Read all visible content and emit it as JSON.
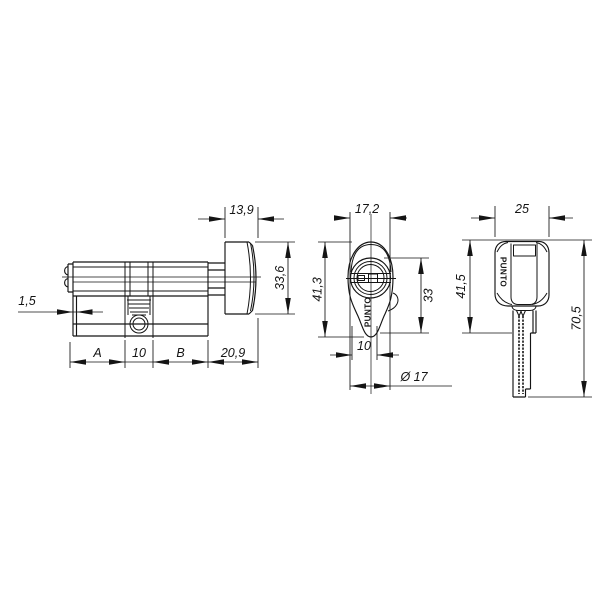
{
  "drawing": {
    "background": "#ffffff",
    "line_color": "#141414",
    "views": {
      "side": {
        "dims": {
          "knob_width": "13,9",
          "knob_height": "33,6",
          "cam_lip": "1,5",
          "half_a": "A",
          "center_width": "10",
          "half_b": "B",
          "knob_total": "20,9"
        }
      },
      "front": {
        "dims": {
          "face_width": "17,2",
          "face_height": "41,3",
          "body_height": "33",
          "keyway_width": "10",
          "plug_diameter": "Ø 17"
        },
        "brand": "PUNTO"
      },
      "key": {
        "dims": {
          "head_width": "25",
          "head_height": "41,5",
          "total_length": "70,5"
        },
        "brand": "PUNTO"
      }
    }
  }
}
